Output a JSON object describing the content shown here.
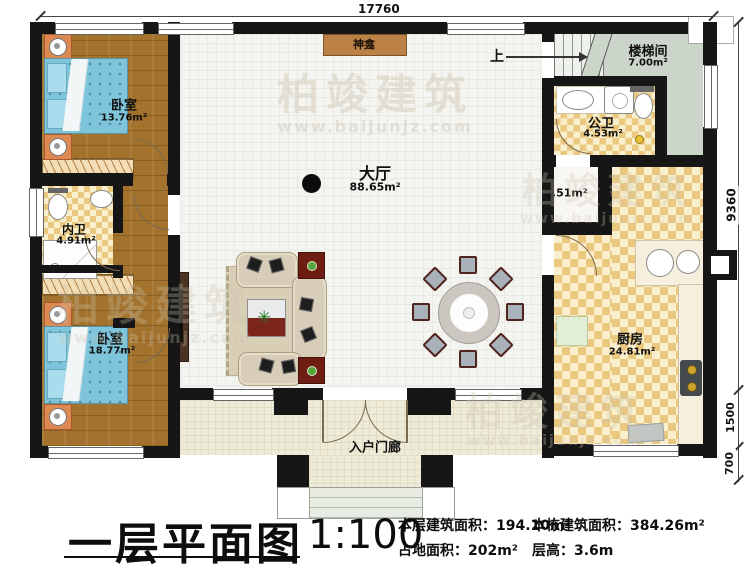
{
  "meta": {
    "title": "一层平面图",
    "scale": "1:100"
  },
  "stats": {
    "floor_area_label": "本层建筑面积：",
    "floor_area_value": "194.10m²",
    "footprint_label": "占地面积：",
    "footprint_value": "202m²",
    "building_area_label": "本栋建筑面积：",
    "building_area_value": "384.26m²",
    "story_height_label": "层高：",
    "story_height_value": "3.6m"
  },
  "dimensions": {
    "top_width": "17760",
    "right_main": "9360",
    "right_porch": "1500",
    "right_steps": "700"
  },
  "rooms": {
    "bedroom_top": {
      "name": "卧室",
      "area": "13.76m²"
    },
    "inner_bath": {
      "name": "内卫",
      "area": "4.91m²"
    },
    "bedroom_bottom": {
      "name": "卧室",
      "area": "18.77m²"
    },
    "hall": {
      "name": "大厅",
      "area": "88.65m²"
    },
    "stairwell": {
      "name": "楼梯间",
      "area": "7.00m²"
    },
    "public_bath": {
      "name": "公卫",
      "area": "4.53m²"
    },
    "closet": {
      "area": "1.51m²"
    },
    "kitchen": {
      "name": "厨房",
      "area": "24.81m²"
    },
    "porch": {
      "name": "入户门廊"
    },
    "shrine": {
      "name": "神龛"
    },
    "stairs_up": "上"
  },
  "watermark": {
    "brand": "柏竣建筑",
    "url": "www.baijunjz.com"
  }
}
